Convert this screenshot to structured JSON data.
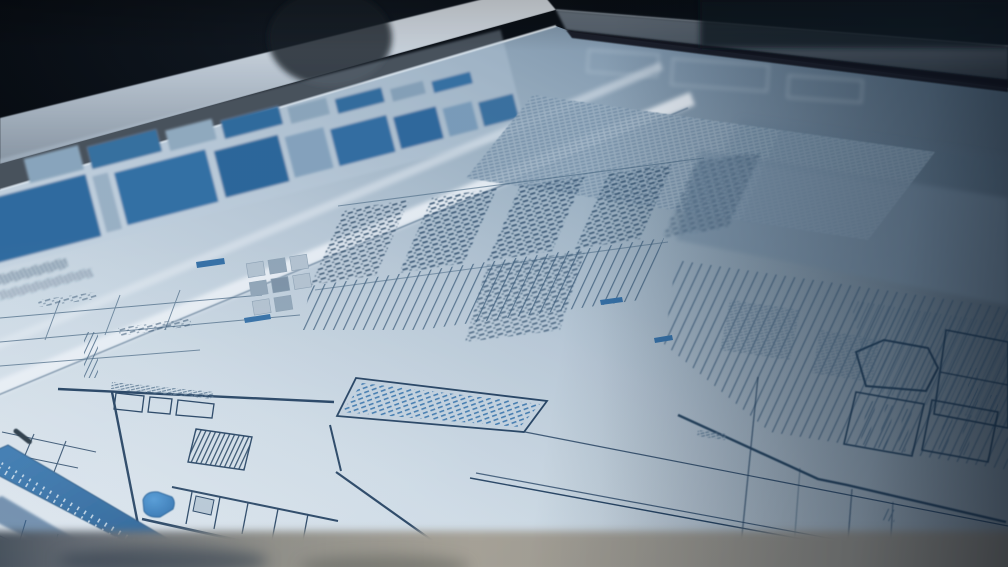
{
  "scene": {
    "type": "photograph",
    "subject": "architectural blueprint sheet lying on a drafting light-table, viewed at a steep low angle",
    "surroundings": "dark room, near-black background above the table frame",
    "focus": "sharp in lower-left foreground, increasingly blurred toward the far upper-right",
    "legible_text": "none — all annotations are sub-legible microtext"
  },
  "palette": {
    "background": "#04070b",
    "bezel_light": "#dfe7ee",
    "bezel_dark": "#49535d",
    "paper_light": "#e6edf3",
    "paper_mid": "#b9c8d5",
    "paper_shadow": "#6d8498",
    "ink": "#27496b",
    "ink_faint": "#5d7a93",
    "legend_blue": "#2e6ca1",
    "accent_blue_bright": "#2e7ec4",
    "band_blue": "#2f6ca3",
    "highlight_strip": "#f2f6fa",
    "table_front_edge": "#a59e90"
  },
  "regions": [
    {
      "name": "table-bezel-left",
      "desc": "bright aluminum-gray frame edge running down to the left"
    },
    {
      "name": "table-bezel-right",
      "desc": "darker gray frame edge receding to the right"
    },
    {
      "name": "legend-band",
      "desc": "two receding rows of solid steel-blue rectangular blocks along the sheet's far edge",
      "near_row_blocks": 9,
      "far_row_blocks": 8
    },
    {
      "name": "fold-highlight-strips",
      "desc": "two long bright diagonal streaks across the sheet"
    },
    {
      "name": "microtext-field",
      "desc": "large dense block of tiny print, center-top, blurring toward right"
    },
    {
      "name": "paragraph-columns",
      "desc": "five columns of dense microtext paragraphs mid-sheet",
      "count": 5
    },
    {
      "name": "rule-fans",
      "desc": "fans of closely spaced parallel table rules, center and right"
    },
    {
      "name": "spec-note-quad",
      "desc": "slanted rectangle holding a blue microtext paragraph, lower center-left"
    },
    {
      "name": "floor-plan-lines",
      "desc": "thick plan outlines, room cells, stair hatch, small boxes, lower-left"
    },
    {
      "name": "plan-marker-blob",
      "desc": "solid bright-blue rounded marker inside plan, lower-left"
    },
    {
      "name": "title-band",
      "desc": "solid blue diagonal strip with faint white microtext, bottom-left corner"
    },
    {
      "name": "right-plan-boxes",
      "desc": "hexagon outline and label boxes with vertical microtext, right side"
    },
    {
      "name": "table-front-edge",
      "desc": "blurred warm-gray front edge of the table, bottom of frame"
    }
  ]
}
